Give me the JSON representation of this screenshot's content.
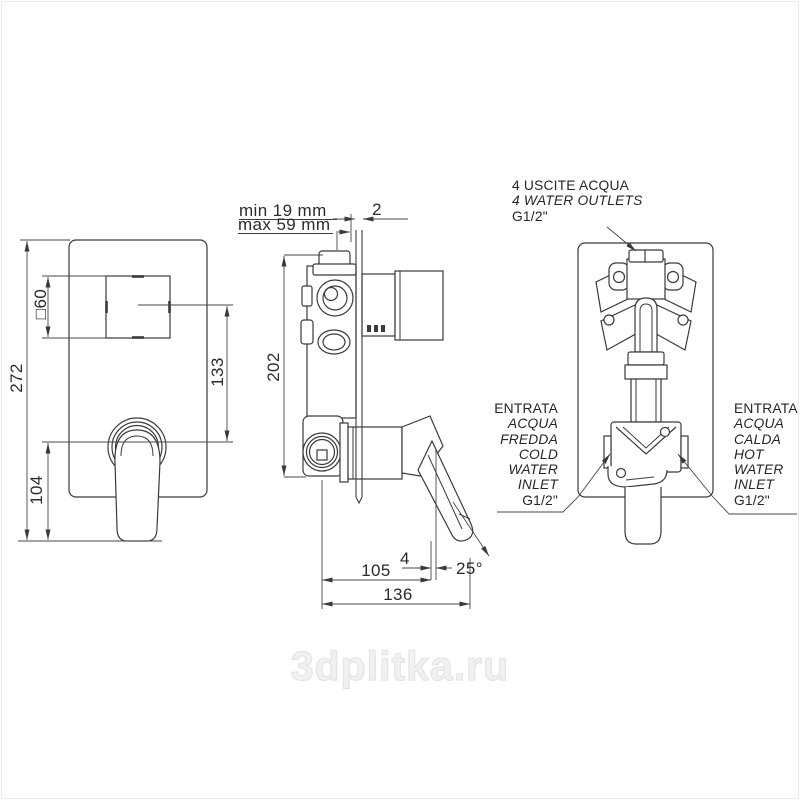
{
  "page": {
    "watermark": "3dplitka.ru"
  },
  "views": {
    "front": {
      "dims": {
        "total_height": "272",
        "square_plate": "□60",
        "handle_offset": "133",
        "handle_overhang": "104"
      }
    },
    "side": {
      "dims": {
        "body_height": "202",
        "plate_thickness": "2",
        "depth_min": "min 19 mm",
        "depth_max": "max 59 mm",
        "depth_to_lever": "105",
        "lever_tip_offset": "4",
        "total_depth": "136",
        "lever_angle": "25°"
      }
    },
    "back": {
      "outlets_label": {
        "line1": "4 USCITE ACQUA",
        "line2": "4 WATER OUTLETS",
        "line3": "G1/2\""
      },
      "cold_inlet_label": {
        "lines": [
          "ENTRATA",
          "ACQUA",
          "FREDDA",
          "COLD",
          "WATER",
          "INLET",
          "G1/2\""
        ]
      },
      "hot_inlet_label": {
        "lines": [
          "ENTRATA",
          "ACQUA",
          "CALDA",
          "HOT",
          "WATER",
          "INLET",
          "G1/2\""
        ]
      }
    }
  }
}
